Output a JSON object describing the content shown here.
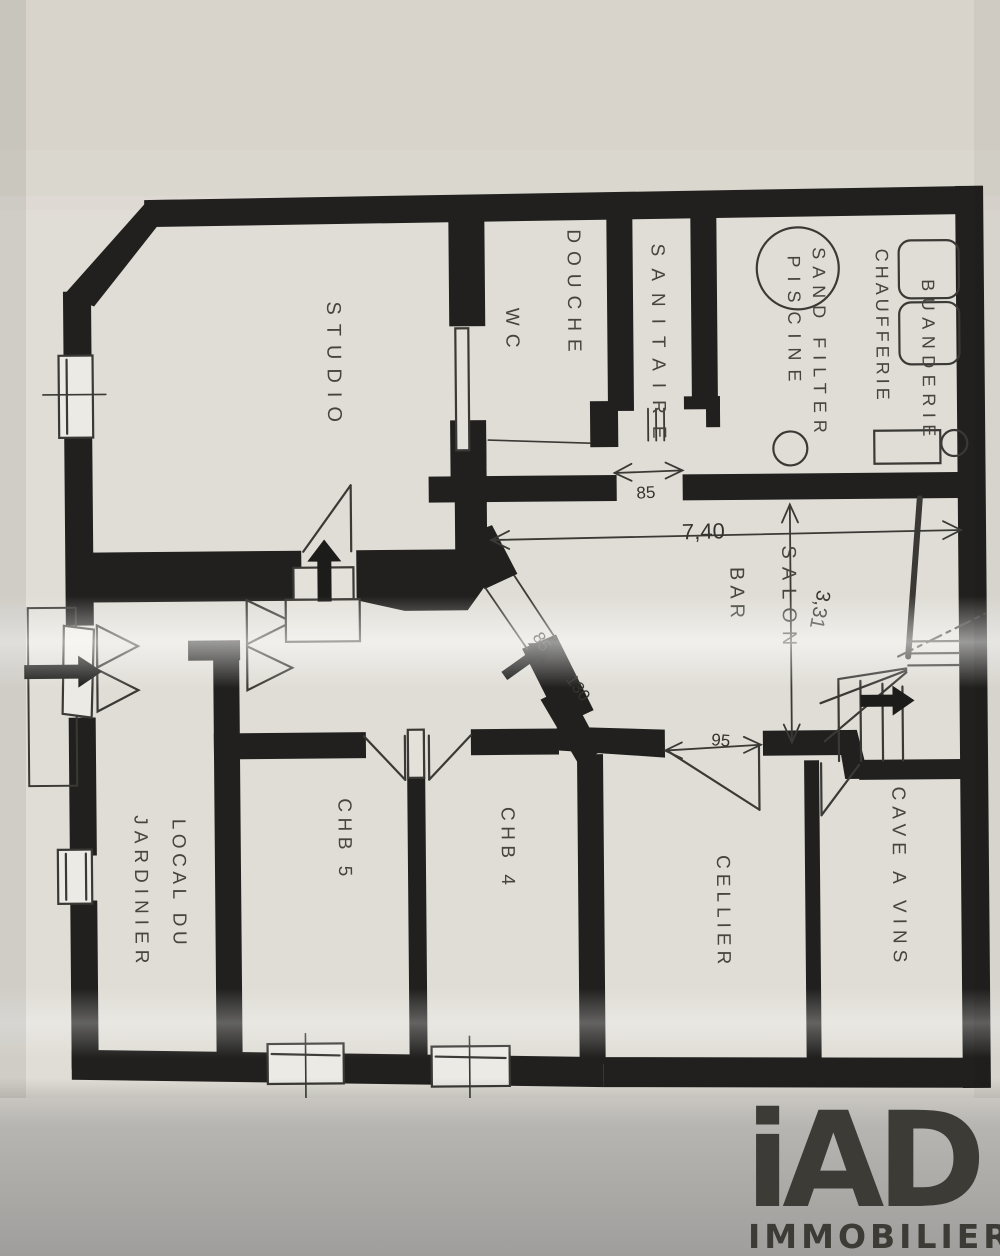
{
  "photo": {
    "paper_color": "#e4e1da",
    "background_top": "#d8d4cb",
    "bottom_surface": "#a8a7a4",
    "wall_ink": "#21201e",
    "line_ink": "#3a3935",
    "logo_color": "#f3f2f0"
  },
  "plan": {
    "rooms": [
      {
        "id": "studio",
        "label": "STUDIO"
      },
      {
        "id": "douche",
        "label": "DOUCHE"
      },
      {
        "id": "wc",
        "label": "WC"
      },
      {
        "id": "sanitaire",
        "label": "SANITAIRE"
      },
      {
        "id": "sand-filter-piscine",
        "label": "SAND FILTER",
        "label2": "PISCINE"
      },
      {
        "id": "chaufferie",
        "label": "CHAUFFERIE"
      },
      {
        "id": "buanderie",
        "label": "BUANDERIE"
      },
      {
        "id": "salon",
        "label": "SALON"
      },
      {
        "id": "bar",
        "label": "BAR"
      },
      {
        "id": "chb5",
        "label": "CHB 5"
      },
      {
        "id": "chb4",
        "label": "CHB 4"
      },
      {
        "id": "cellier",
        "label": "CELLIER"
      },
      {
        "id": "cave-a-vins",
        "label": "CAVE A VINS"
      },
      {
        "id": "local-du-jardinier",
        "label": "LOCAL DU",
        "label2": "JARDINIER"
      }
    ],
    "dimensions": {
      "overall_width": "7,40",
      "salon_depth": "3,31",
      "sanitaire_door": "85",
      "hall_door": "85",
      "hall_passage": "130",
      "cellier_door": "95"
    }
  },
  "logo": {
    "brand": "iAD",
    "subtitle": "IMMOBILIER"
  }
}
